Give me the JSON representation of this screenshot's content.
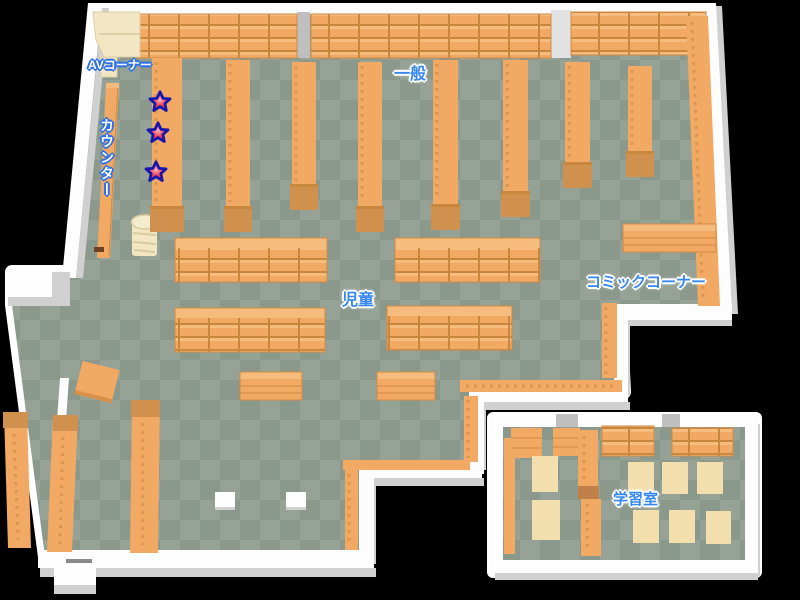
{
  "labels": {
    "av_corner": "AVコーナー",
    "counter": "カウンター",
    "general": "一般",
    "children": "児童",
    "comic_corner": "コミックコーナー",
    "study_room": "学習室"
  },
  "markers": {
    "type": "star",
    "count": 3
  },
  "colors": {
    "background": "#000000",
    "floor_tile_a": "#95a295",
    "floor_tile_b": "#8b998d",
    "wall": "#fdfdfd",
    "wall_shadow": "#d0d0d0",
    "wall_gap": "#bfbfbf",
    "shelf": "#f2a963",
    "shelf_light": "#f6bc7e",
    "shelf_dark": "#c9873d",
    "shelf_cap": "#d1914e",
    "shelf_edge": "#d08a45",
    "furniture_cream": "#f2e6c4",
    "table_cream": "#f3dfae",
    "star_fill": "#ee3d4c",
    "star_highlight": "#ffb3bc",
    "star_outline": "#1717b0",
    "label_blue": "#3787f0",
    "label_outline": "#2f6fe8"
  }
}
